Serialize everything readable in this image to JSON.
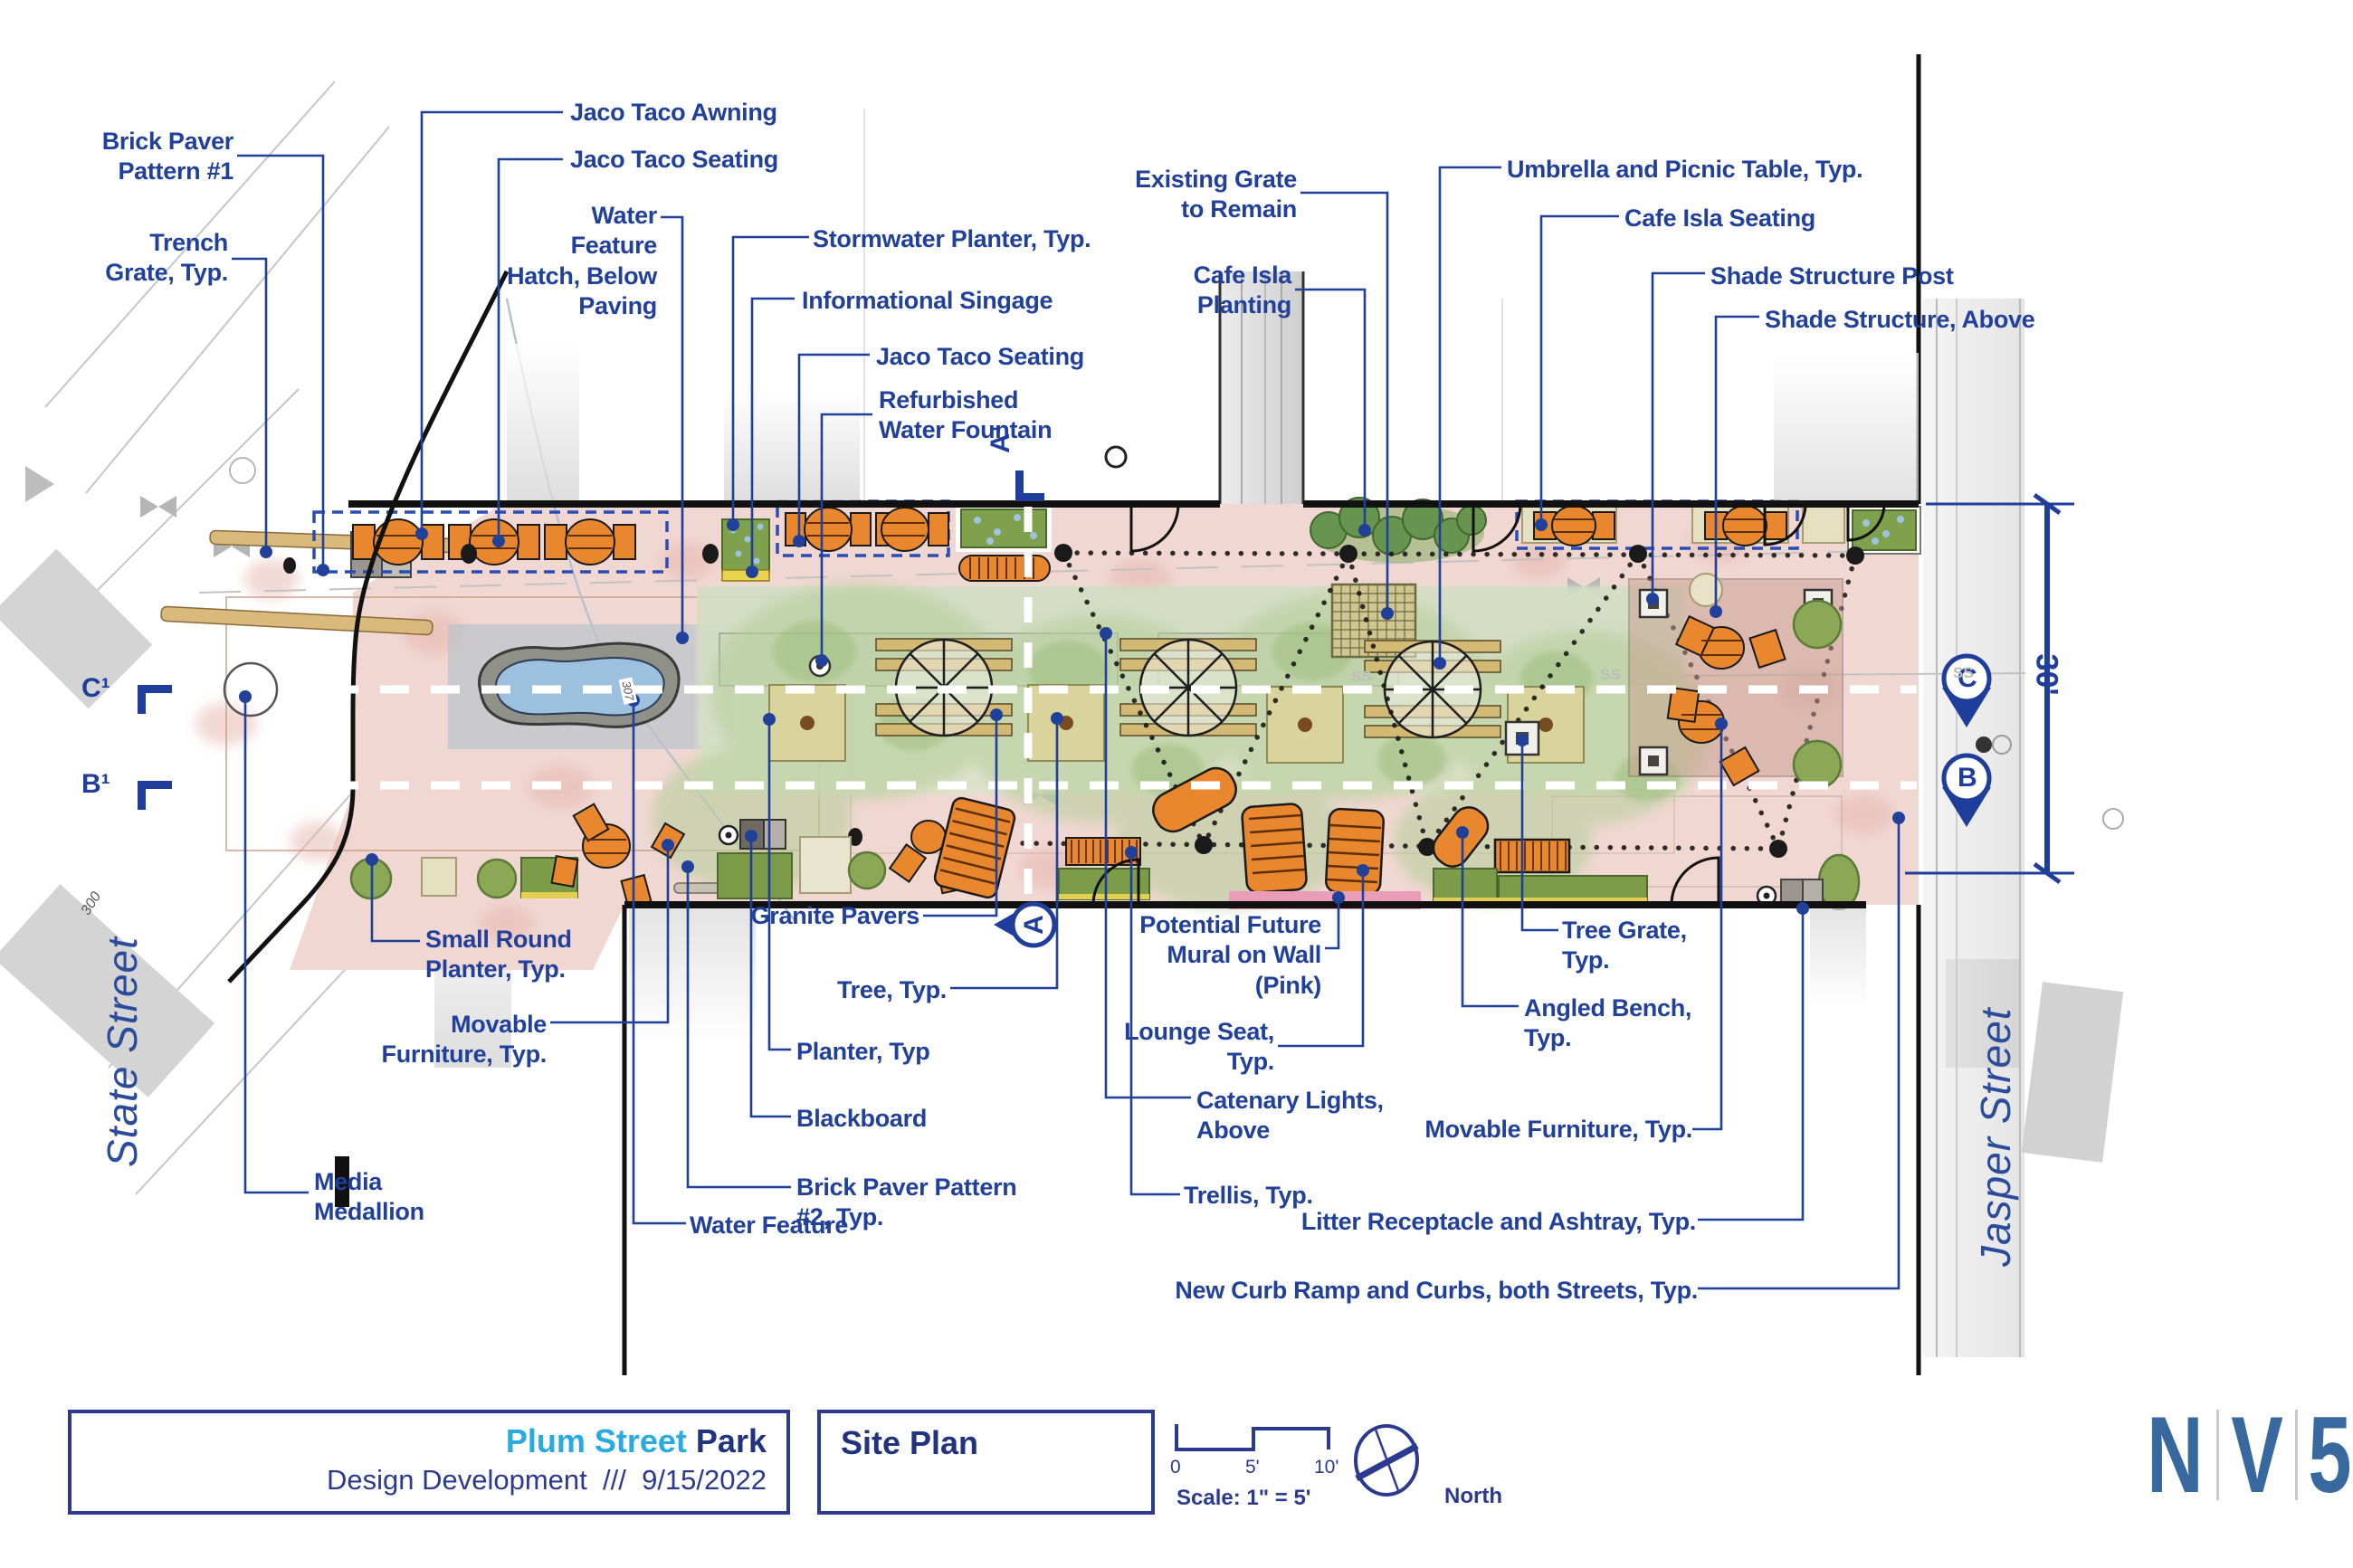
{
  "title_block": {
    "project_highlight": "Plum Street",
    "project_rest": " Park",
    "phase": "Design Development",
    "separator": "///",
    "date": "9/15/2022",
    "sheet_name": "Site Plan"
  },
  "scale_bar": {
    "tick0": "0",
    "tick5": "5'",
    "tick10": "10'",
    "scale_text": "Scale: 1\" = 5'",
    "north_label": "North"
  },
  "logo": {
    "letters": [
      "N",
      "V",
      "5"
    ]
  },
  "streets": {
    "left": "State Street",
    "right": "Jasper Street"
  },
  "markers": {
    "left_c": "C¹",
    "left_b": "B¹",
    "right_c": "C",
    "right_b": "B",
    "top_a": "A¹",
    "bottom_a": "A",
    "dimension_right": "30'"
  },
  "annotations": {
    "survey_mark": "300",
    "pond_tag": "307",
    "utility_label": "SS"
  },
  "colors": {
    "callout_navy": "#21409a",
    "title_cyan": "#29abe2",
    "title_navy": "#21337e",
    "logo_blue": "#38699e",
    "paving_pink": "#f1d7d2",
    "lawn_green": "#d9e4c8",
    "furniture_orange": "#e8872e",
    "mural_pink": "#ea9db6",
    "planter_green": "#8aa855"
  },
  "callouts": [
    {
      "id": "brick-paver-pattern-1",
      "text": "Brick Paver\nPattern #1"
    },
    {
      "id": "trench-grate",
      "text": "Trench\nGrate, Typ."
    },
    {
      "id": "jaco-taco-awning",
      "text": "Jaco Taco Awning"
    },
    {
      "id": "jaco-taco-seating-1",
      "text": "Jaco Taco Seating"
    },
    {
      "id": "water-feature-hatch",
      "text": "Water\nFeature\nHatch, Below\nPaving"
    },
    {
      "id": "stormwater-planter",
      "text": "Stormwater Planter, Typ."
    },
    {
      "id": "informational-singage",
      "text": "Informational Singage"
    },
    {
      "id": "jaco-taco-seating-2",
      "text": "Jaco Taco Seating"
    },
    {
      "id": "refurbished-water-fountain",
      "text": "Refurbished\nWater Fountain"
    },
    {
      "id": "existing-grate",
      "text": "Existing Grate\nto Remain"
    },
    {
      "id": "cafe-isla-planting",
      "text": "Cafe Isla\nPlanting"
    },
    {
      "id": "umbrella-picnic-table",
      "text": "Umbrella and Picnic Table, Typ."
    },
    {
      "id": "cafe-isla-seating",
      "text": "Cafe Isla Seating"
    },
    {
      "id": "shade-structure-post",
      "text": "Shade Structure Post"
    },
    {
      "id": "shade-structure-above",
      "text": "Shade Structure, Above"
    },
    {
      "id": "small-round-planter",
      "text": "Small Round\nPlanter, Typ."
    },
    {
      "id": "movable-furniture-1",
      "text": "Movable\nFurniture, Typ."
    },
    {
      "id": "media-medallion",
      "text": "Media\nMedallion"
    },
    {
      "id": "granite-pavers",
      "text": "Granite Pavers"
    },
    {
      "id": "tree-typ",
      "text": "Tree, Typ."
    },
    {
      "id": "planter-typ",
      "text": "Planter, Typ"
    },
    {
      "id": "blackboard",
      "text": "Blackboard"
    },
    {
      "id": "brick-paver-pattern-2",
      "text": "Brick Paver Pattern\n#2, Typ."
    },
    {
      "id": "water-feature",
      "text": "Water Feature"
    },
    {
      "id": "potential-future-mural",
      "text": "Potential Future\nMural on Wall\n(Pink)"
    },
    {
      "id": "lounge-seat",
      "text": "Lounge Seat,\nTyp."
    },
    {
      "id": "catenary-lights",
      "text": "Catenary Lights,\nAbove"
    },
    {
      "id": "trellis",
      "text": "Trellis, Typ."
    },
    {
      "id": "tree-grate",
      "text": "Tree Grate,\nTyp."
    },
    {
      "id": "angled-bench",
      "text": "Angled Bench,\nTyp."
    },
    {
      "id": "movable-furniture-2",
      "text": "Movable Furniture, Typ."
    },
    {
      "id": "litter-receptacle",
      "text": "Litter Receptacle and Ashtray, Typ."
    },
    {
      "id": "new-curb-ramp",
      "text": "New Curb Ramp and Curbs, both Streets, Typ."
    }
  ]
}
